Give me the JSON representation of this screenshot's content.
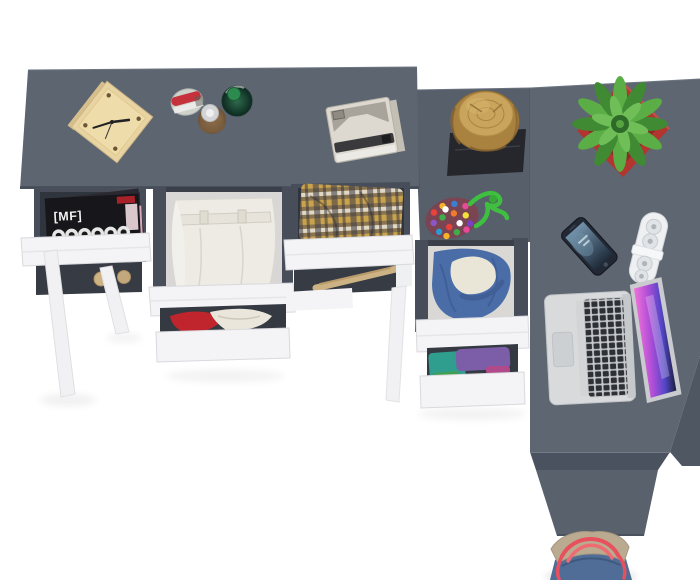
{
  "meta": {
    "type": "product-photo",
    "subject": "Top view of a dark grey L-shaped desk with white pull-out drawers styled with clothes, a laptop, a plant and accessories on a white floor",
    "width": 700,
    "height": 580
  },
  "magazine": {
    "masthead": "[MF]"
  },
  "items": {
    "scene": "Top view of a dark grey L-shaped desk with white pull-out drawers styled with clothes and accessories",
    "main_desk_top": "dark grey desk top",
    "cube_clock": "wooden cube desk clock",
    "perfume_bottles": "three perfume bottles",
    "instant_camera": "instant camera",
    "magazine_drawer": "open drawer with magazines",
    "magazines": "fashion magazines",
    "pants_drawer": "open drawer with folded white trousers",
    "red_clothes_drawer": "open drawer with red and cream clothing",
    "plaid_drawer": "open drawer with checked shirt",
    "wooden_hanger": "wooden hanger",
    "desk_leg": "white angled desk leg",
    "return_top": "desk return section top",
    "log_stool": "natural wood log stool",
    "stool_mat": "black square mat",
    "pompom_pouch": "multicoloured pom-pom pouch",
    "green_cord": "green cord",
    "hoodie_drawer": "open drawer with denim hoodie",
    "folded_clothes_drawer": "open drawer with folded purple and teal clothes",
    "right_desk_top": "right desk top",
    "desk_side_panel": "desk side panel",
    "potted_plant": "green succulent in red planter",
    "smartphone": "smartphone",
    "power_strip": "white power strip",
    "laptop": "open laptop with pink screen",
    "tote_bag": "denim tote bag with red straps"
  },
  "colors": {
    "background": "#ffffff",
    "desk_top_main": "#5d6571",
    "desk_top_return": "#575f6b",
    "desk_top_right": "#5e6672",
    "desk_edge": "#454c57",
    "desk_right_strip": "#4f5763",
    "desk_front_band": "#4a5260",
    "desk_side_panel": "#59616d",
    "drawer_front": "#f4f4f6",
    "cabinet_rail": "#474d59",
    "drawer_interior": "#30343d",
    "leg_white": "#f1f1f3",
    "clock_wood": "#e8d3a2",
    "clock_face": "#eedcab",
    "stump_wood": "#a9823f",
    "stump_top": "#c9a45c",
    "mat_black": "#25272c",
    "plant_green_dark": "#3f8a33",
    "plant_green_light": "#5aae45",
    "pot_red": "#b23530",
    "pot_red_dark": "#8e2a26",
    "laptop_body": "#d8dadc",
    "laptop_key": "#2d3035",
    "phone_body": "#222935",
    "strip_white": "#eef0f2",
    "denim": "#4a6da8",
    "lining_cream": "#e9e6d8",
    "purple_cloth": "#7b5ea7",
    "teal_cloth": "#2f9e8f",
    "red_cloth": "#c0242c",
    "white_pants": "#edebe4",
    "magazine_black": "#17161a",
    "camera_body": "#ddd9d0",
    "camera_slot": "#3a3a3c",
    "hanger_wood": "#cdb283",
    "rope_green": "#3fbf3f",
    "bag_denim": "#4f6d96",
    "bag_trim": "#b9aa90",
    "bag_strap": "#e8505e",
    "perfume_red": "#c5323c",
    "perfume_amber": "#8a6a4a",
    "perfume_green": "#1f4d38"
  }
}
